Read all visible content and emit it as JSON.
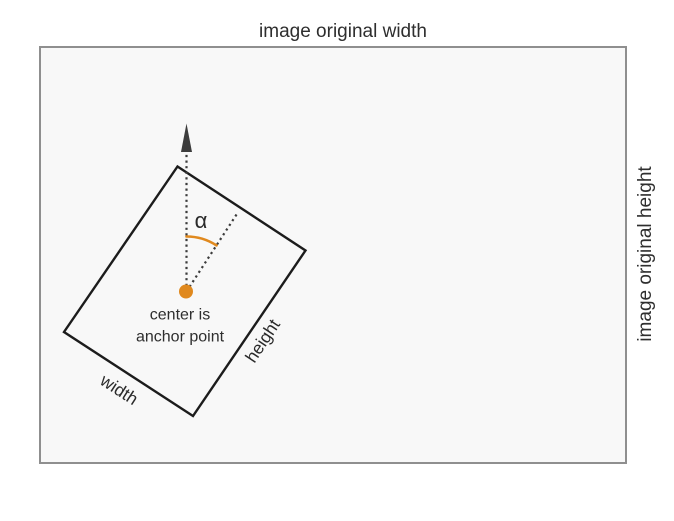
{
  "title": {
    "text": "image original width"
  },
  "right_axis": {
    "text": "image original height"
  },
  "rotated_rect": {
    "angle_label": "α",
    "anchor_caption_line1": "center is",
    "anchor_caption_line2": "anchor point",
    "width_label": "width",
    "height_label": "height"
  },
  "colors": {
    "accent_orange": "#e0891e",
    "outer_box_fill": "#f8f8f8",
    "outer_box_border": "#8f8f8f",
    "rect_stroke": "#1c1c1c",
    "guide_gray": "#3c3c3c",
    "text": "#2e2e2e"
  }
}
